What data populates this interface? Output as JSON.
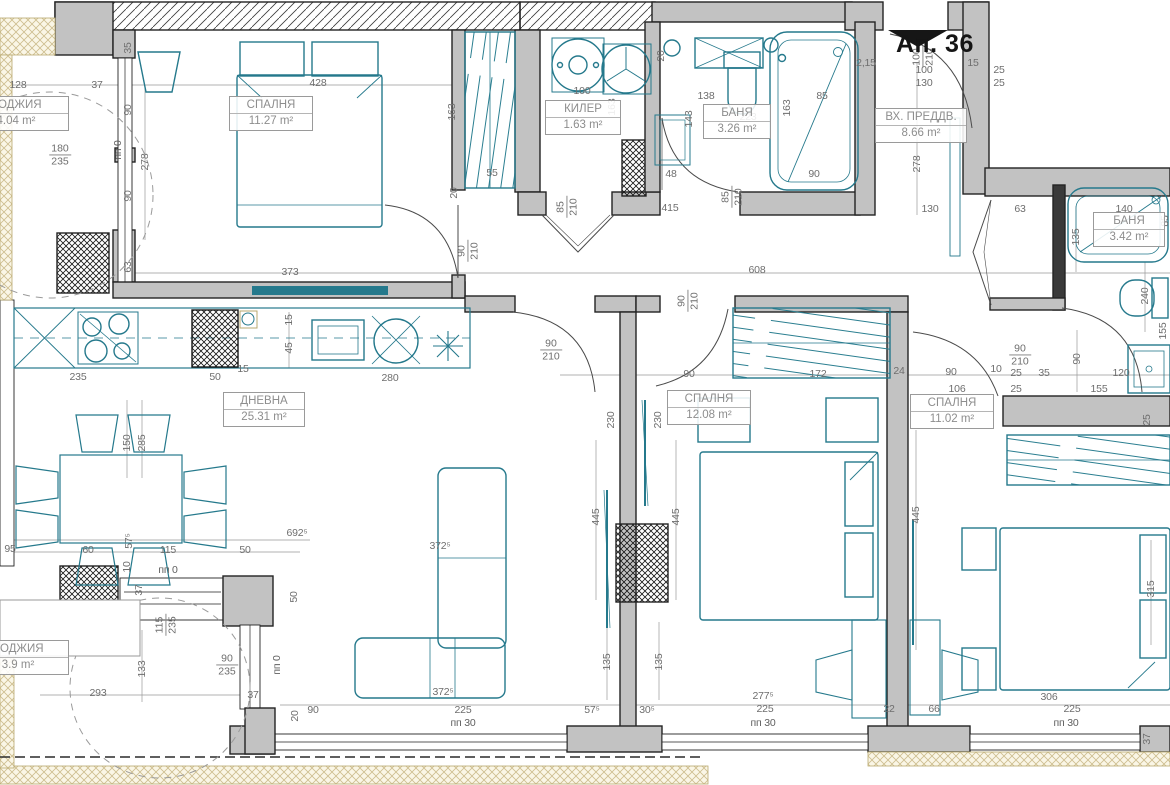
{
  "apartment": {
    "label": "Ап. 36"
  },
  "rooms": [
    {
      "name": "СПАЛНЯ",
      "area": "11.27 m²",
      "x": 271,
      "y": 96,
      "w": 82
    },
    {
      "name": "КИЛЕР",
      "area": "1.63 m²",
      "x": 583,
      "y": 100,
      "w": 74
    },
    {
      "name": "БАНЯ",
      "area": "3.26 m²",
      "x": 737,
      "y": 104,
      "w": 66
    },
    {
      "name": "ВХ. ПРЕДДВ.",
      "area": "8.66 m²",
      "x": 921,
      "y": 108,
      "w": 90
    },
    {
      "name": "БАНЯ",
      "area": "3.42 m²",
      "x": 1129,
      "y": 212,
      "w": 70
    },
    {
      "name": "ДНЕВНА",
      "area": "25.31 m²",
      "x": 264,
      "y": 392,
      "w": 80
    },
    {
      "name": "СПАЛНЯ",
      "area": "12.08 m²",
      "x": 709,
      "y": 390,
      "w": 82
    },
    {
      "name": "СПАЛНЯ",
      "area": "11.02 m²",
      "x": 952,
      "y": 394,
      "w": 82
    },
    {
      "name": "ЛОДЖИЯ",
      "area": "4.04 m²",
      "x": 16,
      "y": 96,
      "w": 104
    },
    {
      "name": "ЛОДЖИЯ",
      "area": "3.9 m²",
      "x": 18,
      "y": 640,
      "w": 100
    }
  ],
  "door_sizes": [
    {
      "a": "90",
      "b": "210",
      "x": 468,
      "y": 251,
      "r": 1
    },
    {
      "a": "85",
      "b": "210",
      "x": 567,
      "y": 207,
      "r": 1
    },
    {
      "a": "85",
      "b": "210",
      "x": 732,
      "y": 197,
      "r": 1
    },
    {
      "a": "100",
      "b": "210",
      "x": 923,
      "y": 57,
      "r": 1
    },
    {
      "a": "90",
      "b": "210",
      "x": 551,
      "y": 350,
      "r": 0
    },
    {
      "a": "90",
      "b": "210",
      "x": 688,
      "y": 301,
      "r": 1
    },
    {
      "a": "90",
      "b": "210",
      "x": 1020,
      "y": 355,
      "r": 0
    },
    {
      "a": "180",
      "b": "235",
      "x": 60,
      "y": 155,
      "r": 0
    },
    {
      "a": "115",
      "b": "235",
      "x": 166,
      "y": 625,
      "r": 1
    },
    {
      "a": "90",
      "b": "235",
      "x": 227,
      "y": 665,
      "r": 0
    }
  ],
  "dimensions": [
    {
      "t": "428",
      "x": 318,
      "y": 83,
      "r": 0
    },
    {
      "t": "373",
      "x": 290,
      "y": 272,
      "r": 0
    },
    {
      "t": "163",
      "x": 452,
      "y": 112,
      "r": 1
    },
    {
      "t": "278",
      "x": 145,
      "y": 162,
      "r": 1
    },
    {
      "t": "90",
      "x": 128,
      "y": 110,
      "r": 1
    },
    {
      "t": "90",
      "x": 128,
      "y": 196,
      "r": 1
    },
    {
      "t": "пп 0",
      "x": 118,
      "y": 150,
      "r": 1
    },
    {
      "t": "35",
      "x": 128,
      "y": 48,
      "r": 1
    },
    {
      "t": "63",
      "x": 128,
      "y": 267,
      "r": 1
    },
    {
      "t": "128",
      "x": 18,
      "y": 85,
      "r": 0
    },
    {
      "t": "37",
      "x": 97,
      "y": 85,
      "r": 0
    },
    {
      "t": "55",
      "x": 492,
      "y": 173,
      "r": 0
    },
    {
      "t": "100",
      "x": 582,
      "y": 91,
      "r": 0
    },
    {
      "t": "163",
      "x": 612,
      "y": 107,
      "r": 1
    },
    {
      "t": "138",
      "x": 706,
      "y": 96,
      "r": 0
    },
    {
      "t": "223",
      "x": 748,
      "y": 117,
      "r": 0
    },
    {
      "t": "20",
      "x": 661,
      "y": 56,
      "r": 1
    },
    {
      "t": "143",
      "x": 689,
      "y": 119,
      "r": 1
    },
    {
      "t": "48",
      "x": 671,
      "y": 174,
      "r": 0
    },
    {
      "t": "85",
      "x": 822,
      "y": 96,
      "r": 0
    },
    {
      "t": "163",
      "x": 787,
      "y": 108,
      "r": 1
    },
    {
      "t": "90",
      "x": 814,
      "y": 174,
      "r": 0
    },
    {
      "t": "415",
      "x": 670,
      "y": 208,
      "r": 0
    },
    {
      "t": "2,15",
      "x": 866,
      "y": 63,
      "r": 0
    },
    {
      "t": "15",
      "x": 973,
      "y": 63,
      "r": 0
    },
    {
      "t": "25",
      "x": 999,
      "y": 70,
      "r": 0
    },
    {
      "t": "25",
      "x": 999,
      "y": 83,
      "r": 0
    },
    {
      "t": "100",
      "x": 924,
      "y": 70,
      "r": 0
    },
    {
      "t": "130",
      "x": 924,
      "y": 83,
      "r": 0
    },
    {
      "t": "130",
      "x": 930,
      "y": 209,
      "r": 0
    },
    {
      "t": "278",
      "x": 917,
      "y": 164,
      "r": 1
    },
    {
      "t": "608",
      "x": 757,
      "y": 270,
      "r": 0
    },
    {
      "t": "20",
      "x": 454,
      "y": 193,
      "r": 1
    },
    {
      "t": "63",
      "x": 1020,
      "y": 209,
      "r": 0
    },
    {
      "t": "140",
      "x": 1124,
      "y": 209,
      "r": 0
    },
    {
      "t": "85",
      "x": 1165,
      "y": 221,
      "r": 1
    },
    {
      "t": "135",
      "x": 1076,
      "y": 237,
      "r": 1
    },
    {
      "t": "240",
      "x": 1145,
      "y": 296,
      "r": 1
    },
    {
      "t": "155",
      "x": 1163,
      "y": 331,
      "r": 1
    },
    {
      "t": "90",
      "x": 1077,
      "y": 359,
      "r": 1
    },
    {
      "t": "120",
      "x": 1121,
      "y": 373,
      "r": 0
    },
    {
      "t": "155",
      "x": 1099,
      "y": 389,
      "r": 0
    },
    {
      "t": "90",
      "x": 951,
      "y": 372,
      "r": 0
    },
    {
      "t": "10",
      "x": 996,
      "y": 369,
      "r": 0
    },
    {
      "t": "25",
      "x": 1016,
      "y": 373,
      "r": 0
    },
    {
      "t": "35",
      "x": 1044,
      "y": 373,
      "r": 0
    },
    {
      "t": "106",
      "x": 957,
      "y": 389,
      "r": 0
    },
    {
      "t": "25",
      "x": 1016,
      "y": 389,
      "r": 0
    },
    {
      "t": "90",
      "x": 689,
      "y": 374,
      "r": 0
    },
    {
      "t": "172",
      "x": 818,
      "y": 374,
      "r": 0
    },
    {
      "t": "24",
      "x": 899,
      "y": 371,
      "r": 0
    },
    {
      "t": "230",
      "x": 611,
      "y": 420,
      "r": 1
    },
    {
      "t": "230",
      "x": 658,
      "y": 420,
      "r": 1
    },
    {
      "t": "445",
      "x": 596,
      "y": 517,
      "r": 1
    },
    {
      "t": "445",
      "x": 676,
      "y": 517,
      "r": 1
    },
    {
      "t": "135",
      "x": 607,
      "y": 662,
      "r": 1
    },
    {
      "t": "135",
      "x": 659,
      "y": 662,
      "r": 1
    },
    {
      "t": "277⁵",
      "x": 763,
      "y": 696,
      "r": 0
    },
    {
      "t": "225",
      "x": 765,
      "y": 709,
      "r": 0
    },
    {
      "t": "пп 30",
      "x": 763,
      "y": 723,
      "r": 0
    },
    {
      "t": "22",
      "x": 889,
      "y": 709,
      "r": 0
    },
    {
      "t": "66",
      "x": 934,
      "y": 709,
      "r": 0
    },
    {
      "t": "445",
      "x": 916,
      "y": 515,
      "r": 1
    },
    {
      "t": "315",
      "x": 1151,
      "y": 589,
      "r": 1
    },
    {
      "t": "25",
      "x": 1147,
      "y": 420,
      "r": 1
    },
    {
      "t": "306",
      "x": 1049,
      "y": 697,
      "r": 0
    },
    {
      "t": "225",
      "x": 1072,
      "y": 709,
      "r": 0
    },
    {
      "t": "пп 30",
      "x": 1066,
      "y": 723,
      "r": 0
    },
    {
      "t": "37",
      "x": 1147,
      "y": 739,
      "r": 1
    },
    {
      "t": "235",
      "x": 78,
      "y": 377,
      "r": 0
    },
    {
      "t": "50",
      "x": 215,
      "y": 377,
      "r": 0
    },
    {
      "t": "15",
      "x": 243,
      "y": 369,
      "r": 0
    },
    {
      "t": "280",
      "x": 390,
      "y": 378,
      "r": 0
    },
    {
      "t": "15",
      "x": 289,
      "y": 320,
      "r": 1
    },
    {
      "t": "45",
      "x": 289,
      "y": 348,
      "r": 1
    },
    {
      "t": "150",
      "x": 127,
      "y": 443,
      "r": 1
    },
    {
      "t": "285",
      "x": 142,
      "y": 443,
      "r": 1
    },
    {
      "t": "372⁵",
      "x": 440,
      "y": 546,
      "r": 0
    },
    {
      "t": "372⁵",
      "x": 443,
      "y": 692,
      "r": 0
    },
    {
      "t": "95",
      "x": 10,
      "y": 549,
      "r": 0
    },
    {
      "t": "60",
      "x": 88,
      "y": 550,
      "r": 0
    },
    {
      "t": "57⁵",
      "x": 129,
      "y": 541,
      "r": 1
    },
    {
      "t": "115",
      "x": 168,
      "y": 550,
      "r": 0
    },
    {
      "t": "50",
      "x": 245,
      "y": 550,
      "r": 0
    },
    {
      "t": "692⁵",
      "x": 297,
      "y": 533,
      "r": 0
    },
    {
      "t": "10",
      "x": 127,
      "y": 567,
      "r": 1
    },
    {
      "t": "пп 0",
      "x": 168,
      "y": 570,
      "r": 0
    },
    {
      "t": "37",
      "x": 139,
      "y": 590,
      "r": 1
    },
    {
      "t": "50",
      "x": 294,
      "y": 597,
      "r": 1
    },
    {
      "t": "133",
      "x": 142,
      "y": 669,
      "r": 1
    },
    {
      "t": "293",
      "x": 98,
      "y": 693,
      "r": 0
    },
    {
      "t": "37",
      "x": 253,
      "y": 695,
      "r": 0
    },
    {
      "t": "пп 0",
      "x": 277,
      "y": 665,
      "r": 1
    },
    {
      "t": "20",
      "x": 295,
      "y": 716,
      "r": 1
    },
    {
      "t": "90",
      "x": 313,
      "y": 710,
      "r": 0
    },
    {
      "t": "225",
      "x": 463,
      "y": 710,
      "r": 0
    },
    {
      "t": "пп 30",
      "x": 463,
      "y": 723,
      "r": 0
    },
    {
      "t": "57⁵",
      "x": 592,
      "y": 710,
      "r": 0
    },
    {
      "t": "30⁵",
      "x": 647,
      "y": 710,
      "r": 0
    }
  ],
  "colors": {
    "wall_fill": "#c2c2c2",
    "wall_stroke": "#232323",
    "furniture": "#25798c",
    "dim_text": "#6e6e6e",
    "cream_hatch": "#cdbd8e",
    "shaft": "#111111"
  }
}
